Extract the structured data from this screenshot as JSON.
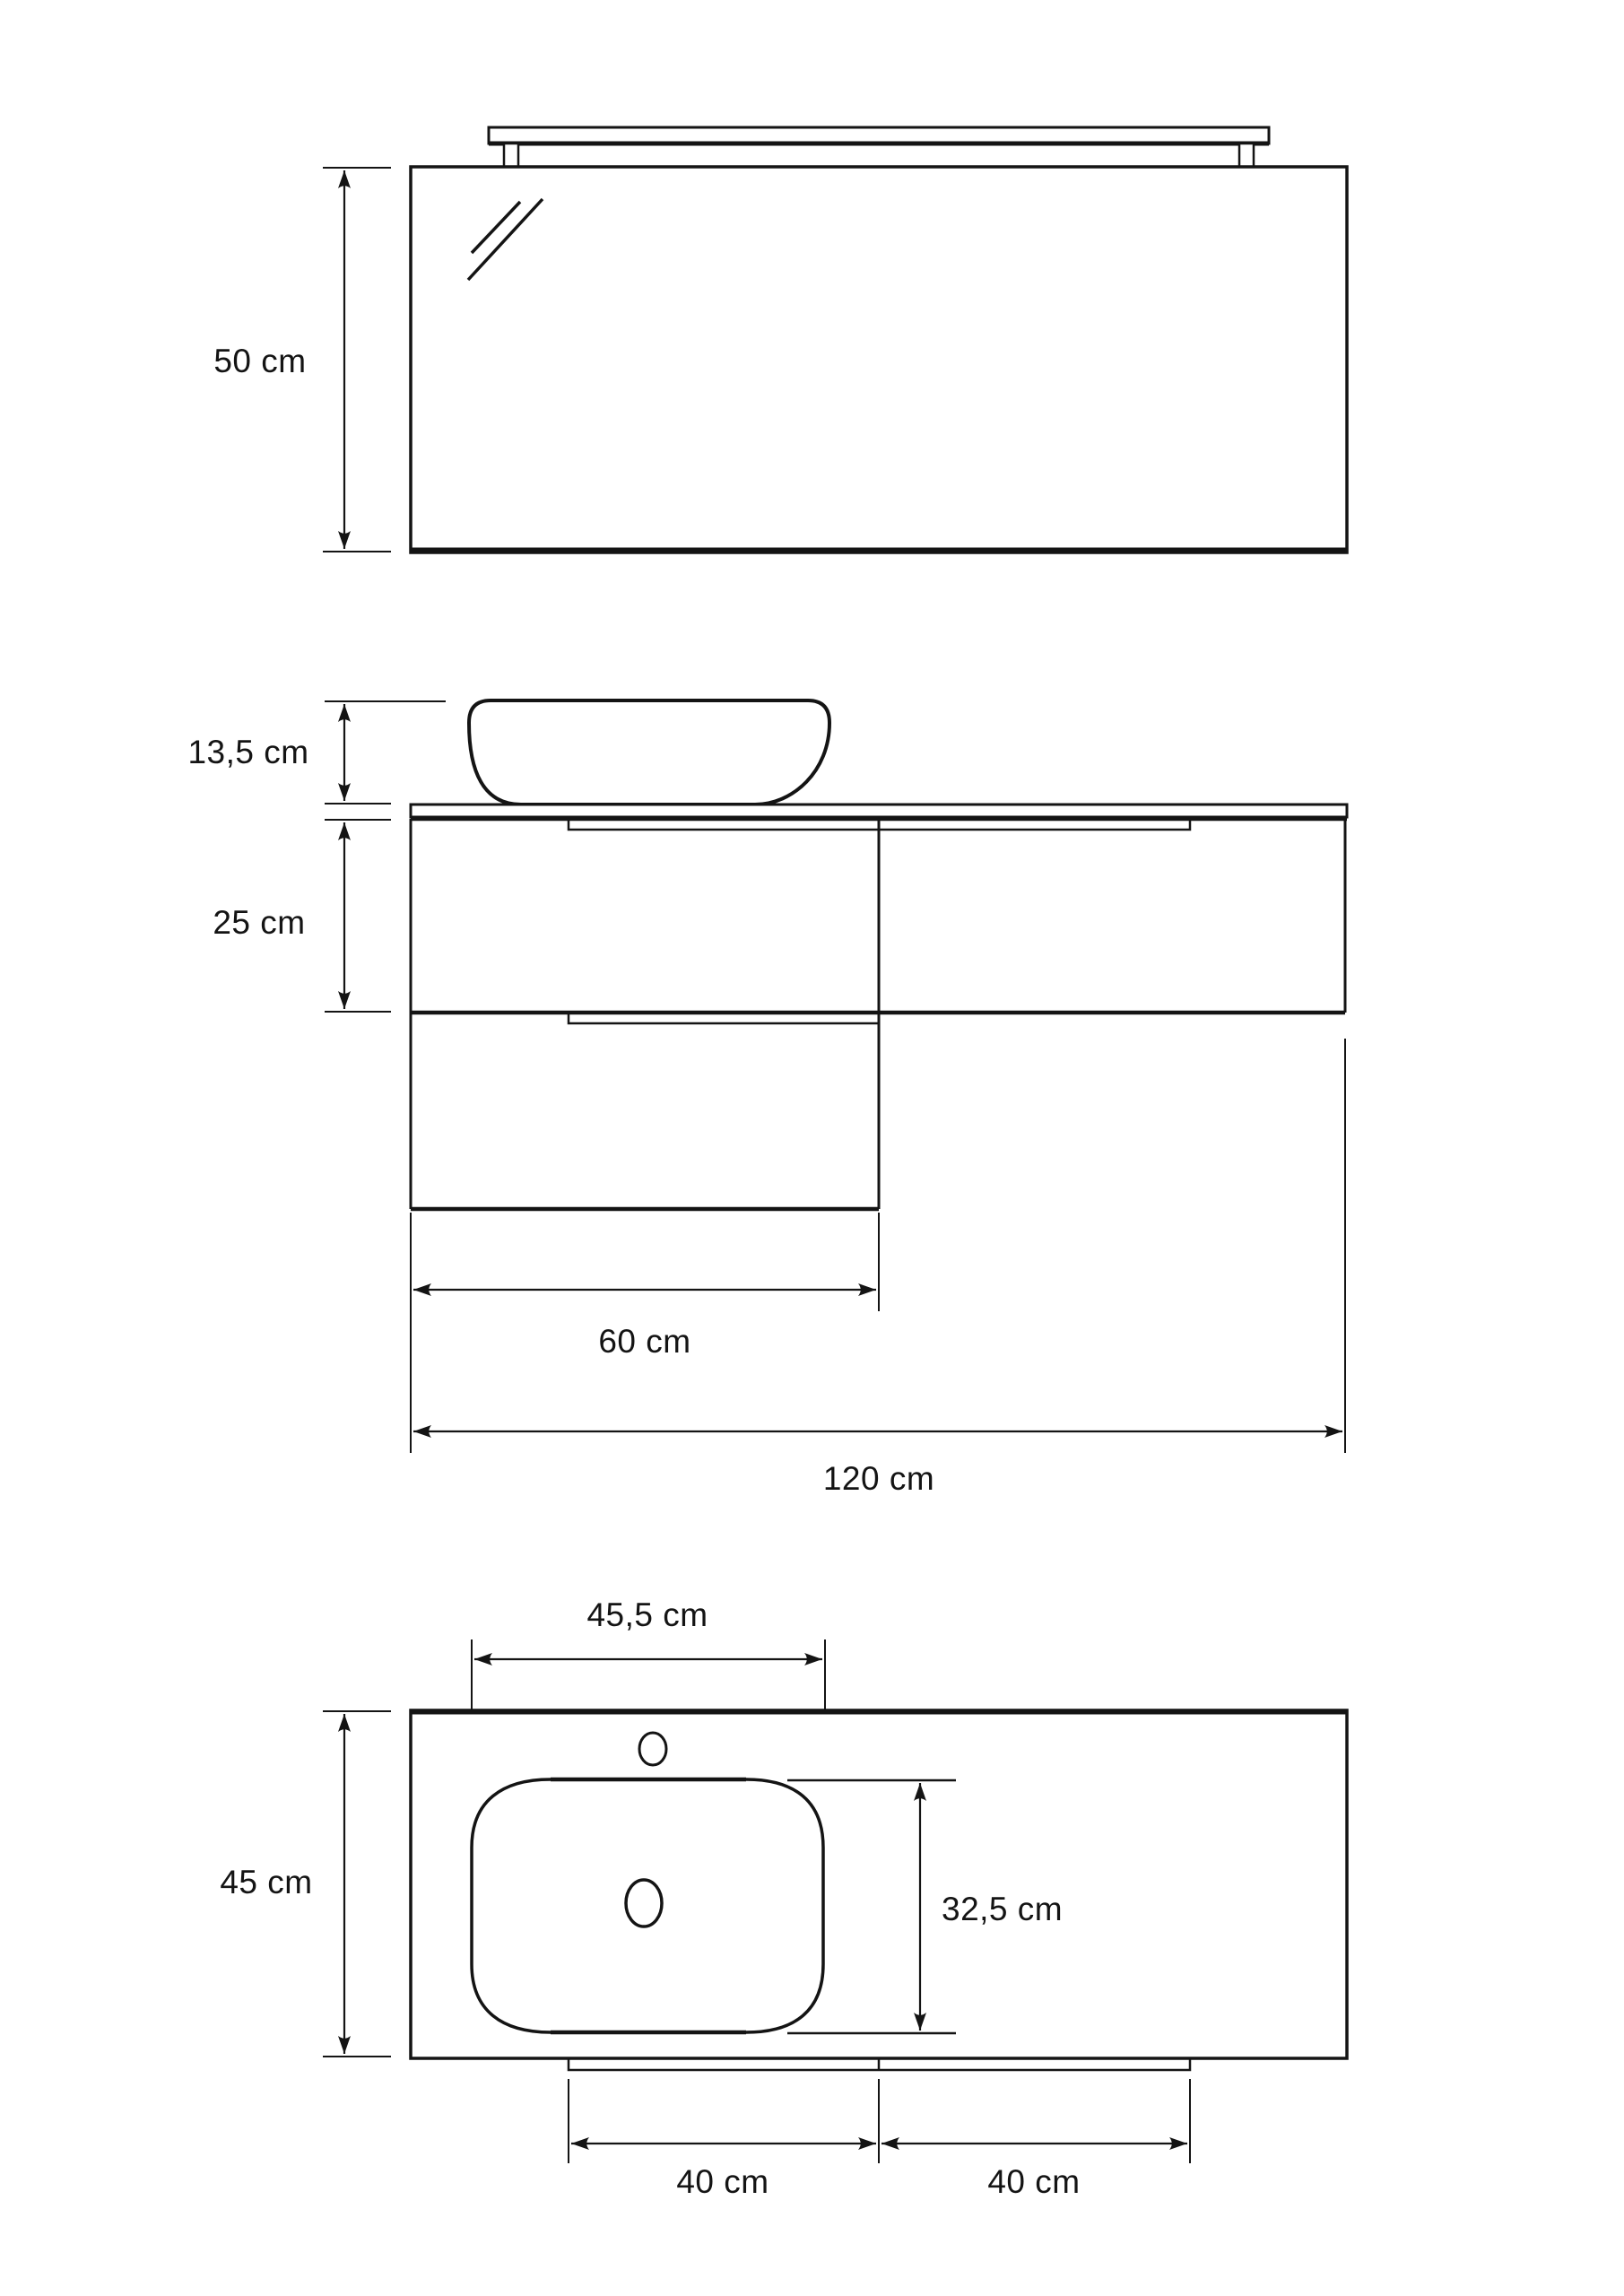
{
  "meta": {
    "kind": "technical-drawing",
    "subject": "bathroom vanity set: mirror with light fixture, vessel basin on countertop with drawers, countertop plan view"
  },
  "colors": {
    "background": "#ffffff",
    "line": "#141414",
    "text": "#141414"
  },
  "views": [
    {
      "id": "mirror-elevation",
      "parts": [
        "light-fixture",
        "mirror"
      ]
    },
    {
      "id": "vanity-elevation",
      "parts": [
        "vessel-basin",
        "countertop",
        "left-cabinet-drawers",
        "right-cabinet"
      ]
    },
    {
      "id": "countertop-plan",
      "parts": [
        "countertop",
        "faucet-hole",
        "basin",
        "drain-hole",
        "drawer-front-edges"
      ]
    }
  ],
  "unit": "cm",
  "dimensions": {
    "mirror_height": {
      "value": 50,
      "label": "50 cm"
    },
    "basin_height": {
      "value": 13.5,
      "label": "13,5 cm"
    },
    "cabinet_height": {
      "value": 25,
      "label": "25 cm"
    },
    "left_cabinet_width": {
      "value": 60,
      "label": "60 cm"
    },
    "total_width": {
      "value": 120,
      "label": "120 cm"
    },
    "basin_top_width": {
      "value": 45.5,
      "label": "45,5 cm"
    },
    "countertop_depth": {
      "value": 45,
      "label": "45 cm"
    },
    "basin_top_depth": {
      "value": 32.5,
      "label": "32,5 cm"
    },
    "left_drawer_width": {
      "value": 40,
      "label": "40 cm"
    },
    "right_drawer_width": {
      "value": 40,
      "label": "40 cm"
    }
  }
}
